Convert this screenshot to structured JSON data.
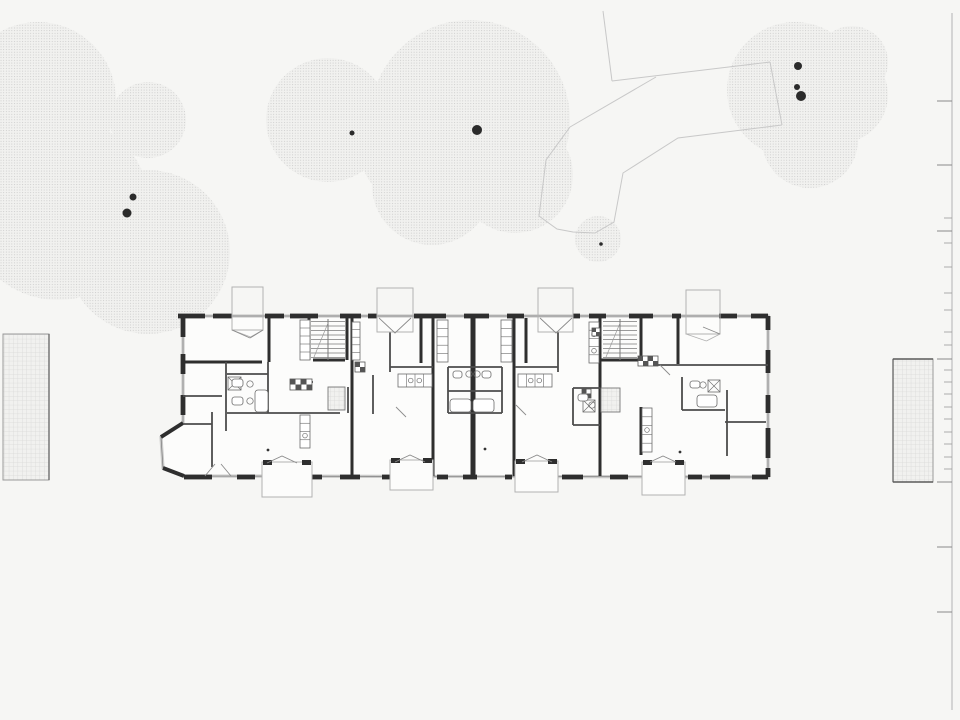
{
  "scene": {
    "width": 960,
    "height": 720,
    "background": "#f6f6f4"
  },
  "colors": {
    "canopy_dot": "#c6c6c6",
    "canopy_bg": "#f1f1ef",
    "trunk": "#2b2b2b",
    "path_line": "#c8c8c8",
    "grid_line": "#d9d9d8",
    "grid_bg": "#f1f1ef",
    "plaza_border": "#9a9a9a",
    "plaza_border_dark": "#5a5a5a",
    "ruler_line": "#b3b3b3",
    "tick": "#9a9a9a",
    "building_fill": "#fcfcfb",
    "window_band": "#cccccb",
    "window_line": "#7d7d7d",
    "wall_dark": "#2e2e2e",
    "wall_med": "#4c4c4c",
    "porch_line": "#b2b2b2",
    "fixture": "#6b6b6b",
    "door": "#8a8a8a",
    "dot": "#333333"
  },
  "trees": {
    "canopies": [
      {
        "id": "top-left",
        "circles": [
          [
            38,
            100,
            78
          ],
          [
            58,
            208,
            92
          ],
          [
            148,
            252,
            82
          ],
          [
            148,
            120,
            38
          ]
        ]
      },
      {
        "id": "mid-left",
        "circles": [
          [
            328,
            120,
            62
          ]
        ]
      },
      {
        "id": "center",
        "circles": [
          [
            470,
            120,
            100
          ],
          [
            432,
            185,
            60
          ],
          [
            515,
            175,
            58
          ],
          [
            415,
            150,
            55
          ]
        ]
      },
      {
        "id": "small",
        "circles": [
          [
            598,
            239,
            23
          ]
        ]
      },
      {
        "id": "top-right",
        "circles": [
          [
            795,
            90,
            68
          ],
          [
            840,
            95,
            48
          ],
          [
            810,
            140,
            48
          ],
          [
            852,
            62,
            36
          ]
        ]
      }
    ],
    "trunks": [
      [
        133,
        197,
        3.5
      ],
      [
        127,
        213,
        4.5
      ],
      [
        352,
        133,
        2.5
      ],
      [
        477,
        130,
        5
      ],
      [
        601,
        244,
        1.8
      ],
      [
        798,
        66,
        4
      ],
      [
        797,
        87,
        3
      ],
      [
        801,
        96,
        5
      ]
    ]
  },
  "footpaths": {
    "polylines": [
      [
        603,
        11,
        612,
        81
      ],
      [
        612,
        81,
        770,
        62
      ],
      [
        570,
        127,
        656,
        77
      ],
      [
        770,
        62,
        782,
        125
      ],
      [
        570,
        127,
        546,
        160,
        539,
        216,
        557,
        229,
        573,
        232,
        595,
        233,
        614,
        222,
        623,
        173,
        678,
        138,
        782,
        125
      ]
    ]
  },
  "plazas": {
    "left": {
      "x": 3,
      "y": 334,
      "w": 46,
      "h": 146
    },
    "right": {
      "x": 893,
      "y": 359,
      "w": 40,
      "h": 123
    }
  },
  "ruler": {
    "x": 952,
    "y1": 13,
    "y2": 710,
    "small_len": 8,
    "major_len": 15,
    "ticks": [
      {
        "y": 101,
        "m": 1
      },
      {
        "y": 165,
        "m": 1
      },
      {
        "y": 218
      },
      {
        "y": 231,
        "m": 1
      },
      {
        "y": 243
      },
      {
        "y": 267
      },
      {
        "y": 293
      },
      {
        "y": 310
      },
      {
        "y": 332
      },
      {
        "y": 345
      },
      {
        "y": 359,
        "m": 1
      },
      {
        "y": 370
      },
      {
        "y": 382
      },
      {
        "y": 394
      },
      {
        "y": 407
      },
      {
        "y": 419
      },
      {
        "y": 432
      },
      {
        "y": 444
      },
      {
        "y": 457
      },
      {
        "y": 469
      },
      {
        "y": 482,
        "m": 1
      },
      {
        "y": 547,
        "m": 1
      },
      {
        "y": 612,
        "m": 1
      }
    ]
  },
  "building": {
    "envelope": [
      [
        183,
        316
      ],
      [
        768,
        316
      ],
      [
        768,
        477
      ],
      [
        184,
        476
      ],
      [
        163,
        468
      ],
      [
        161,
        437
      ],
      [
        183,
        423
      ]
    ],
    "piers": {
      "top": [
        [
          178,
          205
        ],
        [
          213,
          232
        ],
        [
          265,
          284
        ],
        [
          290,
          318
        ],
        [
          340,
          361
        ],
        [
          368,
          377
        ],
        [
          414,
          446
        ],
        [
          464,
          489
        ],
        [
          507,
          524
        ],
        [
          573,
          580
        ],
        [
          589,
          606
        ],
        [
          629,
          653
        ],
        [
          672,
          681
        ],
        [
          719,
          737
        ],
        [
          751,
          768
        ]
      ],
      "bottom": [
        [
          184,
          212
        ],
        [
          237,
          255
        ],
        [
          308,
          322
        ],
        [
          340,
          360
        ],
        [
          382,
          390
        ],
        [
          437,
          448
        ],
        [
          463,
          477
        ],
        [
          505,
          512
        ],
        [
          562,
          583
        ],
        [
          610,
          628
        ],
        [
          688,
          702
        ],
        [
          710,
          730
        ],
        [
          752,
          768
        ]
      ],
      "left": [
        [
          316,
          337
        ],
        [
          354,
          374
        ],
        [
          395,
          415
        ]
      ],
      "right": [
        [
          316,
          330
        ],
        [
          350,
          373
        ],
        [
          395,
          413
        ],
        [
          428,
          458
        ],
        [
          468,
          477
        ]
      ]
    },
    "chamfer_walls": [
      [
        183,
        423,
        161,
        437
      ],
      [
        163,
        468,
        184,
        476
      ]
    ],
    "center_wall": [
      473,
      316,
      473,
      478
    ],
    "dark_walls": [
      [
        352,
        318,
        352,
        476
      ],
      [
        433,
        318,
        433,
        476
      ],
      [
        514,
        318,
        514,
        476
      ],
      [
        600,
        318,
        600,
        476
      ],
      [
        641,
        318,
        641,
        365
      ],
      [
        641,
        407,
        641,
        455
      ],
      [
        269,
        318,
        269,
        362
      ],
      [
        421,
        318,
        421,
        363
      ],
      [
        526,
        318,
        526,
        363
      ],
      [
        678,
        318,
        678,
        364
      ],
      [
        309,
        318,
        309,
        360
      ],
      [
        347,
        318,
        347,
        360
      ],
      [
        183,
        362,
        262,
        362
      ],
      [
        313,
        360,
        345,
        360
      ],
      [
        601,
        360,
        639,
        360
      ]
    ],
    "med_walls": [
      [
        226,
        362,
        226,
        431
      ],
      [
        212,
        412,
        212,
        467
      ],
      [
        183,
        396,
        222,
        396
      ],
      [
        183,
        424,
        212,
        424
      ],
      [
        227,
        374,
        268,
        374
      ],
      [
        227,
        413,
        340,
        413
      ],
      [
        268,
        362,
        268,
        413
      ],
      [
        390,
        332,
        390,
        372
      ],
      [
        558,
        332,
        558,
        372
      ],
      [
        373,
        375,
        373,
        414
      ],
      [
        448,
        367,
        502,
        367
      ],
      [
        448,
        413,
        502,
        413
      ],
      [
        448,
        391,
        502,
        391
      ],
      [
        448,
        367,
        448,
        413
      ],
      [
        502,
        367,
        502,
        413
      ],
      [
        390,
        367,
        433,
        367
      ],
      [
        515,
        367,
        558,
        367
      ],
      [
        641,
        365,
        768,
        365
      ],
      [
        725,
        422,
        766,
        422
      ],
      [
        727,
        390,
        727,
        456
      ],
      [
        682,
        377,
        682,
        410
      ],
      [
        682,
        410,
        725,
        410
      ],
      [
        573,
        388,
        600,
        388
      ],
      [
        573,
        425,
        600,
        425
      ],
      [
        573,
        388,
        573,
        425
      ],
      [
        307,
        424,
        307,
        443
      ],
      [
        302,
        382,
        313,
        382
      ],
      [
        348,
        387,
        348,
        413
      ]
    ],
    "stairs": [
      {
        "x": 311,
        "y": 319,
        "w": 34,
        "h": 41,
        "treads": 9
      },
      {
        "x": 603,
        "y": 319,
        "w": 34,
        "h": 41,
        "treads": 9
      }
    ],
    "lifts": [
      {
        "x": 328,
        "y": 387,
        "w": 17,
        "h": 23
      },
      {
        "x": 601,
        "y": 388,
        "w": 19,
        "h": 24
      }
    ],
    "counters": [
      {
        "x": 398,
        "y": 374,
        "w": 34,
        "h": 13,
        "cells": 4,
        "sinks": [
          1,
          2
        ]
      },
      {
        "x": 518,
        "y": 374,
        "w": 34,
        "h": 13,
        "cells": 4,
        "sinks": [
          1,
          2
        ]
      },
      {
        "x": 642,
        "y": 408,
        "w": 10,
        "h": 44,
        "cells": 5,
        "sinks": [
          2
        ]
      },
      {
        "x": 589,
        "y": 322,
        "w": 10,
        "h": 41,
        "cells": 5,
        "sinks": [
          1,
          3
        ]
      },
      {
        "x": 300,
        "y": 415,
        "w": 10,
        "h": 33,
        "cells": 4,
        "sinks": [
          2
        ]
      },
      {
        "x": 437,
        "y": 320,
        "w": 11,
        "h": 42,
        "cells": 5,
        "sinks": []
      },
      {
        "x": 501,
        "y": 320,
        "w": 11,
        "h": 42,
        "cells": 5,
        "sinks": []
      },
      {
        "x": 300,
        "y": 320,
        "w": 10,
        "h": 40,
        "cells": 5,
        "sinks": []
      },
      {
        "x": 352,
        "y": 322,
        "w": 8,
        "h": 38,
        "cells": 5,
        "sinks": []
      }
    ],
    "shafts": [
      [
        290,
        379,
        11
      ],
      [
        301,
        379,
        11
      ],
      [
        355,
        362,
        10
      ],
      [
        638,
        356,
        10
      ],
      [
        648,
        356,
        10
      ],
      [
        592,
        328,
        8
      ],
      [
        582,
        389,
        9
      ]
    ],
    "showers": [
      [
        228,
        377,
        13
      ],
      [
        708,
        380,
        12
      ],
      [
        583,
        400,
        12
      ]
    ],
    "fixtures": {
      "tubs": [
        [
          255,
          390,
          13,
          22
        ],
        [
          450,
          399,
          21,
          13
        ],
        [
          473,
          399,
          21,
          13
        ],
        [
          697,
          395,
          20,
          12
        ]
      ],
      "toilets": [
        [
          232,
          379,
          11,
          8
        ],
        [
          232,
          397,
          11,
          8
        ],
        [
          453,
          371,
          9,
          7
        ],
        [
          482,
          371,
          9,
          7
        ],
        [
          578,
          394,
          10,
          7
        ],
        [
          690,
          381,
          10,
          7
        ]
      ],
      "sinks": [
        [
          250,
          384
        ],
        [
          250,
          401
        ],
        [
          469,
          374
        ],
        [
          477,
          374
        ],
        [
          592,
          405
        ],
        [
          703,
          385
        ]
      ]
    },
    "porches": {
      "top": [
        {
          "x": 232,
          "y": 287,
          "w": 31,
          "h": 43
        },
        {
          "x": 377,
          "y": 288,
          "w": 36,
          "h": 44
        },
        {
          "x": 538,
          "y": 288,
          "w": 35,
          "h": 44
        },
        {
          "x": 686,
          "y": 290,
          "w": 34,
          "h": 44
        }
      ],
      "bottom": [
        {
          "x": 262,
          "y": 462,
          "w": 50,
          "h": 35
        },
        {
          "x": 390,
          "y": 460,
          "w": 43,
          "h": 30
        },
        {
          "x": 515,
          "y": 461,
          "w": 43,
          "h": 31
        },
        {
          "x": 642,
          "y": 462,
          "w": 43,
          "h": 33
        }
      ]
    },
    "door_tents": [
      [
        379,
        318,
        395,
        333,
        411,
        318
      ],
      [
        540,
        318,
        556,
        333,
        572,
        318
      ],
      [
        267,
        463,
        282,
        456,
        297,
        463
      ],
      [
        395,
        462,
        410,
        455,
        425,
        462
      ],
      [
        522,
        462,
        537,
        455,
        552,
        462
      ],
      [
        650,
        462,
        663,
        456,
        676,
        462
      ]
    ],
    "door_leaves": [
      [
        232,
        330,
        250,
        338
      ],
      [
        250,
        338,
        263,
        330
      ],
      [
        703,
        327,
        720,
        334
      ],
      [
        516,
        405,
        526,
        415
      ],
      [
        396,
        407,
        406,
        417
      ],
      [
        205,
        476,
        215,
        464
      ],
      [
        221,
        464,
        231,
        476
      ],
      [
        660,
        365,
        670,
        375
      ]
    ],
    "dots": [
      [
        268,
        450
      ],
      [
        485,
        449
      ],
      [
        680,
        452
      ]
    ]
  }
}
